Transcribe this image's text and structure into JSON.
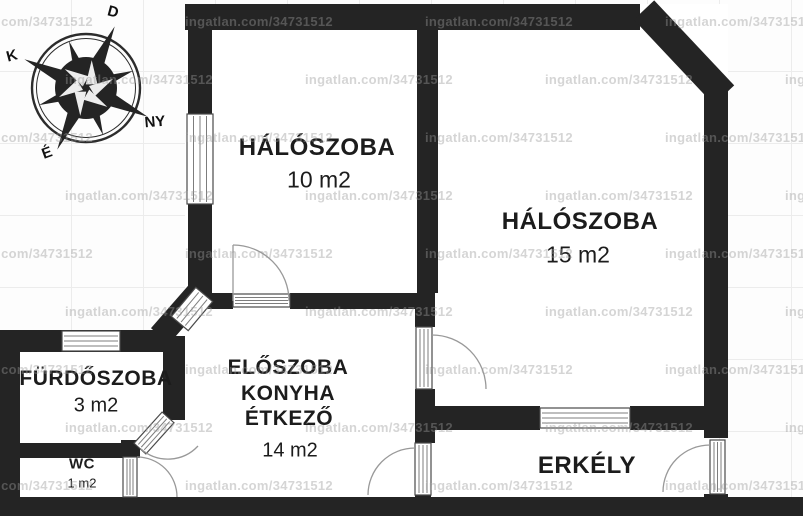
{
  "title": "apartment floor plan",
  "watermark": {
    "text": "ingatlan.com/34731512"
  },
  "compass": {
    "south": "D",
    "east": "K",
    "west": "NY",
    "north": "É"
  },
  "rooms": [
    {
      "id": "bedroom-small",
      "name": "HÁLÓSZOBA",
      "area": "10 m2"
    },
    {
      "id": "bedroom-large",
      "name": "HÁLÓSZOBA",
      "area": "15 m2"
    },
    {
      "id": "bathroom",
      "name": "FÜRDŐSZOBA",
      "area": "3 m2"
    },
    {
      "id": "hall-kitchen-dining",
      "name_lines": [
        "ELŐSZOBA",
        "KONYHA",
        "ÉTKEZŐ"
      ],
      "area": "14 m2"
    },
    {
      "id": "wc",
      "name": "WC",
      "area": "1 m2"
    },
    {
      "id": "balcony",
      "name": "ERKÉLY",
      "area": ""
    }
  ],
  "colors": {
    "wall": "#242424",
    "door_window_line": "#999999",
    "frame": "#4a4a4a",
    "mullion": "#7d7d7d",
    "text": "#1c1c1c",
    "watermark": "rgba(155,155,155,0.42)",
    "grid": "#ececec"
  }
}
